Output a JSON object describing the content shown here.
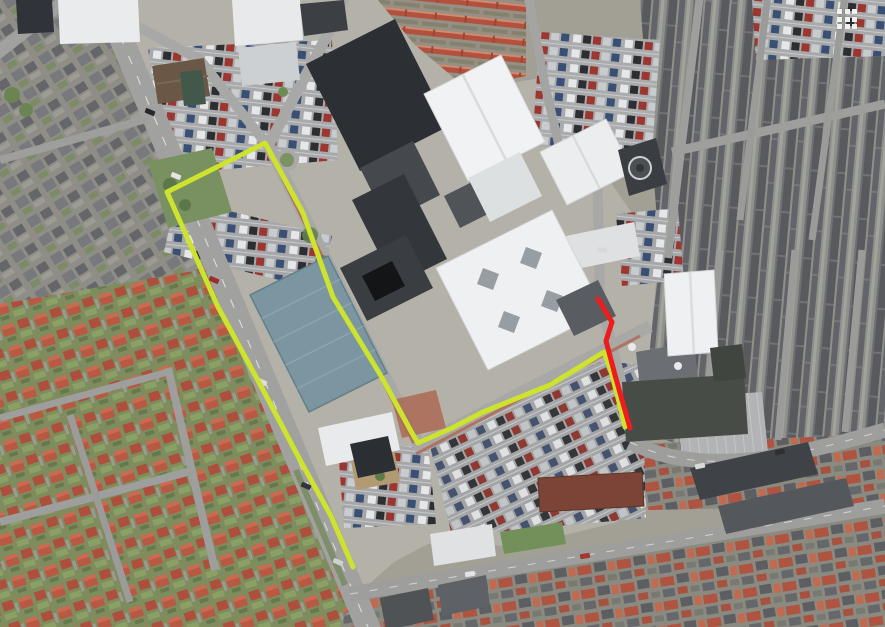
{
  "map": {
    "type": "satellite",
    "routes": {
      "primary": {
        "label": "highlighted-route",
        "color": "#cde32e",
        "points": "353,567 331,516 300,460 262,388 218,307 167,192 265,143 303,213 333,297 381,376 412,433 418,443 452,428 483,412 550,385 604,352 611,371 618,398 625,427"
      },
      "secondary": {
        "label": "red-route-section",
        "color": "#ee1d1d",
        "points": "598,299 612,322 606,341 615,375 622,400 630,428"
      }
    }
  },
  "controls": {
    "apps_grid_icon": {
      "icon": "apps-grid",
      "grid": "3x3",
      "color": "#f1f1ef"
    }
  }
}
